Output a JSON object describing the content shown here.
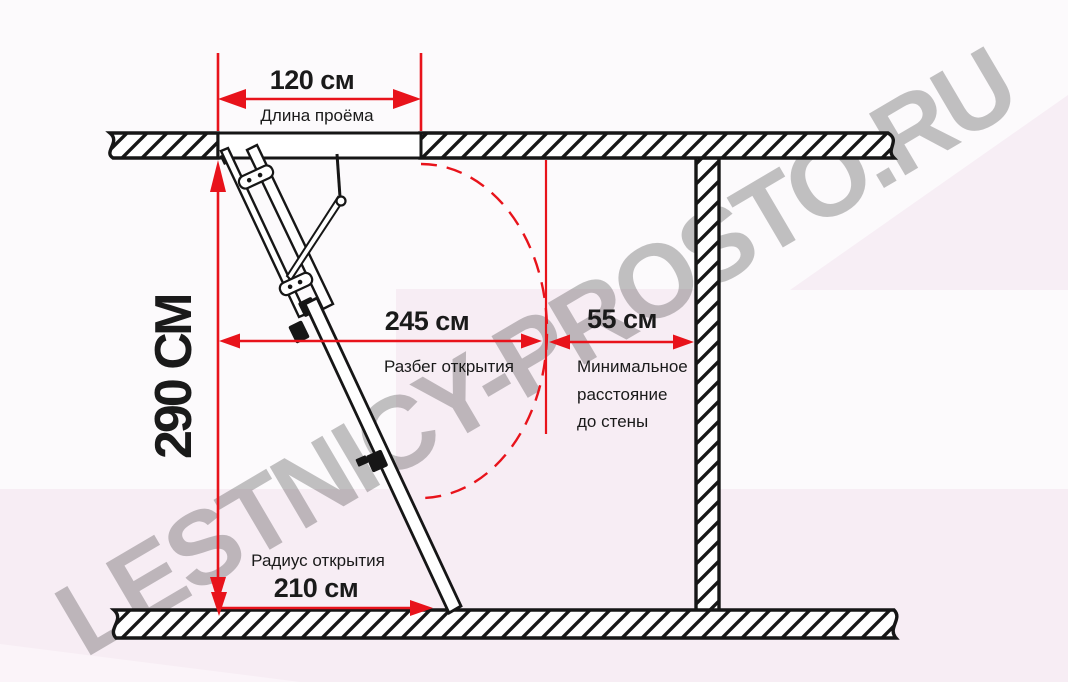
{
  "diagram": {
    "description_visible_text_only": true,
    "dimensions": {
      "opening_length": {
        "value": "120 см",
        "label": "Длина проёма"
      },
      "ceiling_height": {
        "value": "290 СМ"
      },
      "opening_run": {
        "value": "245 см",
        "label": "Разбег открытия"
      },
      "wall_distance": {
        "value": "55 см",
        "label_line1": "Минимальное",
        "label_line2": "расстояние",
        "label_line3": "до стены"
      },
      "opening_radius": {
        "value": "210 см",
        "label": "Радиус открытия"
      }
    },
    "watermark": "LESTNICY-PROSTO.RU",
    "colors": {
      "dimension_red": "#e8131b",
      "line_black": "#161616",
      "background_pink": "#f7edf4",
      "watermark_gray": "#b49cb0"
    }
  }
}
